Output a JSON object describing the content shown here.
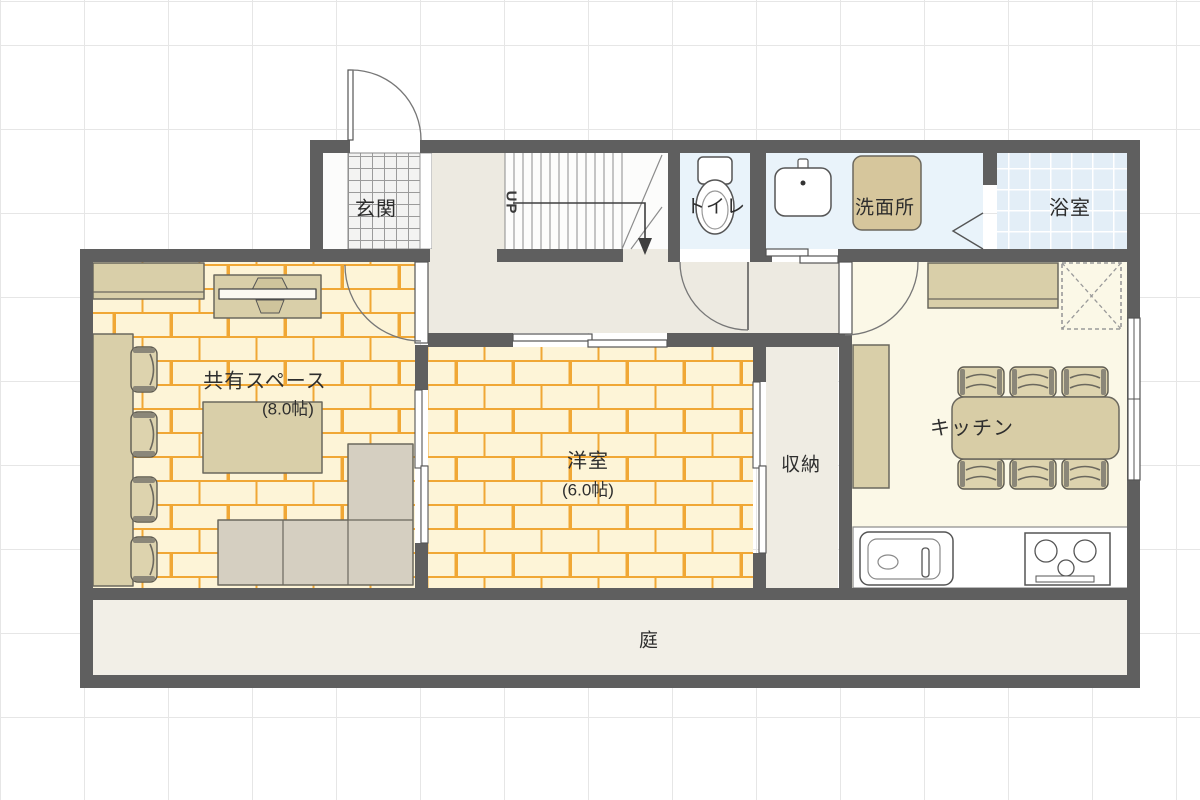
{
  "floorplan": {
    "rooms": {
      "genkan": {
        "label": "玄関"
      },
      "toilet": {
        "label": "トイレ"
      },
      "washroom": {
        "label": "洗面所"
      },
      "bathroom": {
        "label": "浴室"
      },
      "shared": {
        "label": "共有スペース",
        "size": "(8.0帖)"
      },
      "western": {
        "label": "洋室",
        "size": "(6.0帖)"
      },
      "storage": {
        "label": "収納"
      },
      "kitchen": {
        "label": "キッチン"
      },
      "garden": {
        "label": "庭"
      }
    },
    "stairs": {
      "direction_label": "UP"
    },
    "colors": {
      "wall": "#5f5f5f",
      "brick_base": "#fdf4d7",
      "brick_joint": "#f0a735",
      "wet_room_floor": "#e9f3fa",
      "bath_tile": "#e3eef7",
      "hall_floor": "#edeae1",
      "kitchen_floor": "#fbf8e7",
      "garden_floor": "#f2efe7",
      "furniture_tan": "#d9cfa9",
      "sofa": "#d5cfc1",
      "grid": "#e6e6e6"
    }
  }
}
